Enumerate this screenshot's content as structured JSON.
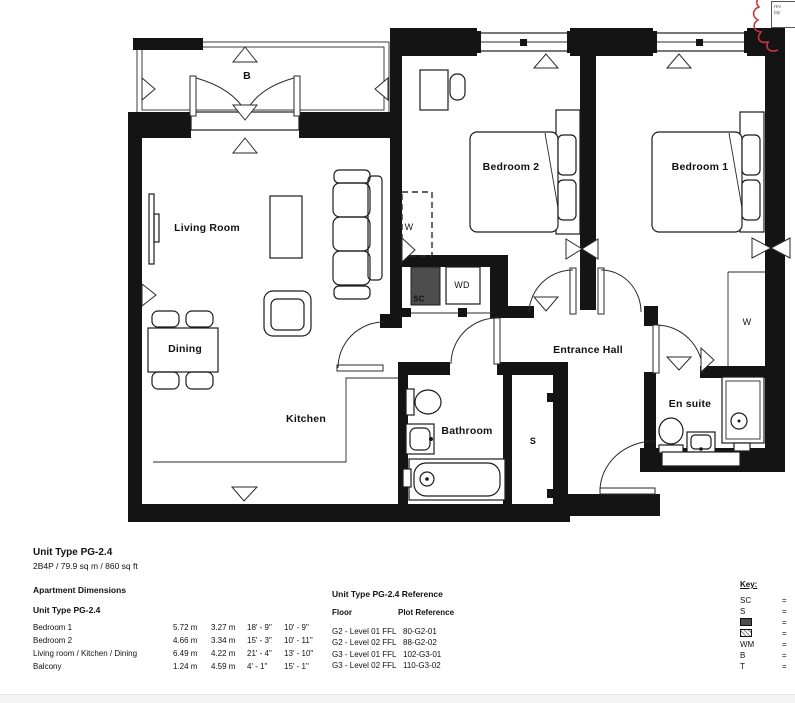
{
  "plan": {
    "labels": {
      "balcony": "B",
      "living_room": "Living Room",
      "dining": "Dining",
      "kitchen": "Kitchen",
      "bedroom2": "Bedroom 2",
      "bedroom1": "Bedroom 1",
      "entrance_hall": "Entrance Hall",
      "bathroom": "Bathroom",
      "en_suite": "En suite",
      "store": "S",
      "store_cupboard": "SC",
      "washer_dryer": "WD",
      "wardrobe_bedroom2": "W",
      "wardrobe_bedroom1": "W"
    }
  },
  "title_block": {
    "unit_type": "Unit Type PG-2.4",
    "summary": "2B4P / 79.9 sq m / 860 sq ft"
  },
  "dimensions": {
    "heading": "Apartment Dimensions",
    "subheading": "Unit Type PG-2.4",
    "rows": [
      {
        "name": "Bedroom 1",
        "w_m": "5.72 m",
        "d_m": "3.27 m",
        "w_ft": "18' - 9\"",
        "d_ft": "10' - 9\""
      },
      {
        "name": "Bedroom 2",
        "w_m": "4.66 m",
        "d_m": "3.34 m",
        "w_ft": "15' - 3\"",
        "d_ft": "10' - 11\""
      },
      {
        "name": "Living room / Kitchen / Dining",
        "w_m": "6.49 m",
        "d_m": "4.22 m",
        "w_ft": "21' - 4\"",
        "d_ft": "13' - 10\""
      },
      {
        "name": "Balcony",
        "w_m": "1.24 m",
        "d_m": "4.59 m",
        "w_ft": "4' - 1\"",
        "d_ft": "15' - 1\""
      }
    ]
  },
  "reference": {
    "heading": "Unit Type PG-2.4 Reference",
    "columns": {
      "floor": "Floor",
      "plot": "Plot Reference"
    },
    "rows": [
      {
        "floor": "G2 - Level 01 FFL",
        "plot": "80-G2-01"
      },
      {
        "floor": "G2 - Level 02 FFL",
        "plot": "88-G2-02"
      },
      {
        "floor": "G3 - Level 01 FFL",
        "plot": "102-G3-01"
      },
      {
        "floor": "G3 - Level 02 FFL",
        "plot": "110-G3-02"
      }
    ]
  },
  "key": {
    "heading": "Key:",
    "equals": "=",
    "items": [
      {
        "label": "SC",
        "icon": ""
      },
      {
        "label": "S",
        "icon": ""
      },
      {
        "label": "",
        "icon": "wardrobe-solid"
      },
      {
        "label": "",
        "icon": "wardrobe-hatch"
      },
      {
        "label": "WM",
        "icon": ""
      },
      {
        "label": "B",
        "icon": ""
      },
      {
        "label": "T",
        "icon": ""
      }
    ]
  },
  "revision_note": {
    "line1": "rev",
    "line2": "lay"
  }
}
